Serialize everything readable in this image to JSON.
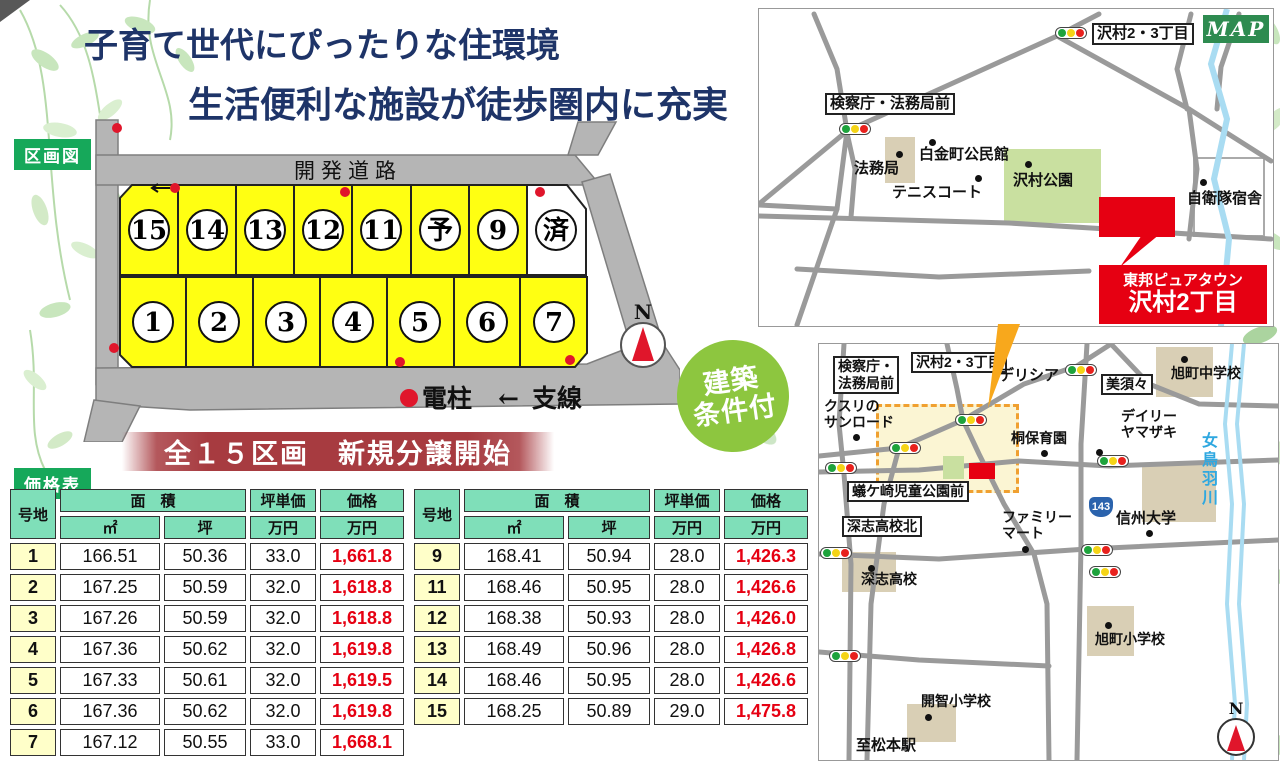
{
  "title": {
    "line1": "子育て世代にぴったりな住環境",
    "line2": "生活便利な施設が徒歩圏内に充実"
  },
  "plan": {
    "section_label": "区画図",
    "road_label": "開発道路",
    "lots_top": [
      "15",
      "14",
      "13",
      "12",
      "11",
      "予",
      "9",
      "済"
    ],
    "lots_bottom": [
      "1",
      "2",
      "3",
      "4",
      "5",
      "6",
      "7"
    ],
    "legend_pole": "電柱",
    "legend_arrow": "←",
    "legend_wire": "支線",
    "compass": "N"
  },
  "badge": {
    "line1": "建築",
    "line2": "条件付"
  },
  "banner": {
    "text": "全１５区画　新規分譲開始"
  },
  "price_table": {
    "section_label": "価格表",
    "col_lot": "号地",
    "col_area": "面　積",
    "col_sqm": "㎡",
    "col_tsubo": "坪",
    "col_unit": "坪単価",
    "col_price": "価格",
    "col_man": "万円",
    "left_rows": [
      {
        "lot": "1",
        "sqm": "166.51",
        "tsubo": "50.36",
        "unit": "33.0",
        "price": "1,661.8"
      },
      {
        "lot": "2",
        "sqm": "167.25",
        "tsubo": "50.59",
        "unit": "32.0",
        "price": "1,618.8"
      },
      {
        "lot": "3",
        "sqm": "167.26",
        "tsubo": "50.59",
        "unit": "32.0",
        "price": "1,618.8"
      },
      {
        "lot": "4",
        "sqm": "167.36",
        "tsubo": "50.62",
        "unit": "32.0",
        "price": "1,619.8"
      },
      {
        "lot": "5",
        "sqm": "167.33",
        "tsubo": "50.61",
        "unit": "32.0",
        "price": "1,619.5"
      },
      {
        "lot": "6",
        "sqm": "167.36",
        "tsubo": "50.62",
        "unit": "32.0",
        "price": "1,619.8"
      },
      {
        "lot": "7",
        "sqm": "167.12",
        "tsubo": "50.55",
        "unit": "33.0",
        "price": "1,668.1"
      }
    ],
    "right_rows": [
      {
        "lot": "9",
        "sqm": "168.41",
        "tsubo": "50.94",
        "unit": "28.0",
        "price": "1,426.3"
      },
      {
        "lot": "11",
        "sqm": "168.46",
        "tsubo": "50.95",
        "unit": "28.0",
        "price": "1,426.6"
      },
      {
        "lot": "12",
        "sqm": "168.38",
        "tsubo": "50.93",
        "unit": "28.0",
        "price": "1,426.0"
      },
      {
        "lot": "13",
        "sqm": "168.49",
        "tsubo": "50.96",
        "unit": "28.0",
        "price": "1,426.8"
      },
      {
        "lot": "14",
        "sqm": "168.46",
        "tsubo": "50.95",
        "unit": "28.0",
        "price": "1,426.6"
      },
      {
        "lot": "15",
        "sqm": "168.25",
        "tsubo": "50.89",
        "unit": "29.0",
        "price": "1,475.8"
      }
    ]
  },
  "map1": {
    "badge": "MAP",
    "labels": {
      "sawamura23": "沢村2・3丁目",
      "kensatsucho": "検察庁・法務局前",
      "homukyoku": "法務局",
      "shirokane": "白金町公民館",
      "tennis": "テニスコート",
      "park": "沢村公園",
      "jieitai": "自衛隊宿舎",
      "callout1": "東邦ピュアタウン",
      "callout2": "沢村2丁目"
    }
  },
  "map2": {
    "labels": {
      "kensatsu1": "検察庁・",
      "kensatsu2": "法務局前",
      "sawamura": "沢村2・3丁目",
      "delicia": "デリシア",
      "misuzu": "美須々",
      "asahi_jhs": "旭町中学校",
      "kusuri1": "クスリの",
      "kusuri2": "サンロード",
      "kiri": "桐保育園",
      "daily1": "デイリー",
      "daily2": "ヤマザキ",
      "arigasaki": "蟻ケ崎児童公園前",
      "fukashi_kita": "深志高校北",
      "family1": "ファミリー",
      "family2": "マート",
      "route": "143",
      "shinshu": "信州大学",
      "metoba": "女鳥羽川",
      "fukashi": "深志高校",
      "asahi_es": "旭町小学校",
      "kaichi": "開智小学校",
      "matsumoto": "至松本駅",
      "compass": "N"
    }
  }
}
